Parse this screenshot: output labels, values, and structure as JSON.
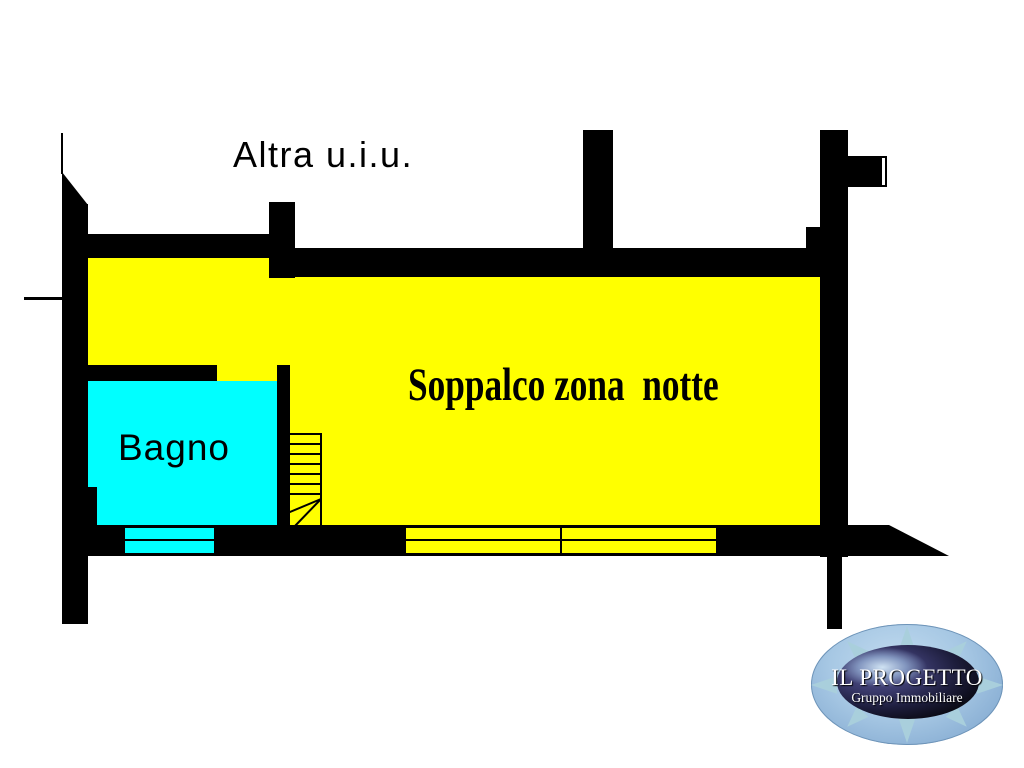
{
  "plan": {
    "labels": {
      "altra_uiu": "Altra u.i.u.",
      "soppalco": "Soppalco zona  notte",
      "bagno": "Bagno"
    },
    "colors": {
      "soppalco_fill": "#FFFF00",
      "bagno_fill": "#00FFFF",
      "wall": "#000000",
      "background": "#FFFFFF"
    }
  },
  "logo": {
    "title": "IL PROGETTO",
    "subtitle": "Gruppo Immobiliare",
    "colors": {
      "outer_ellipse": "#A7C8E4",
      "compass_points": "#A9CFDC",
      "inner_ellipse_dark": "#1D1D3C",
      "inner_highlight": "#D6EAF8",
      "text": "#FFFFFF"
    }
  }
}
